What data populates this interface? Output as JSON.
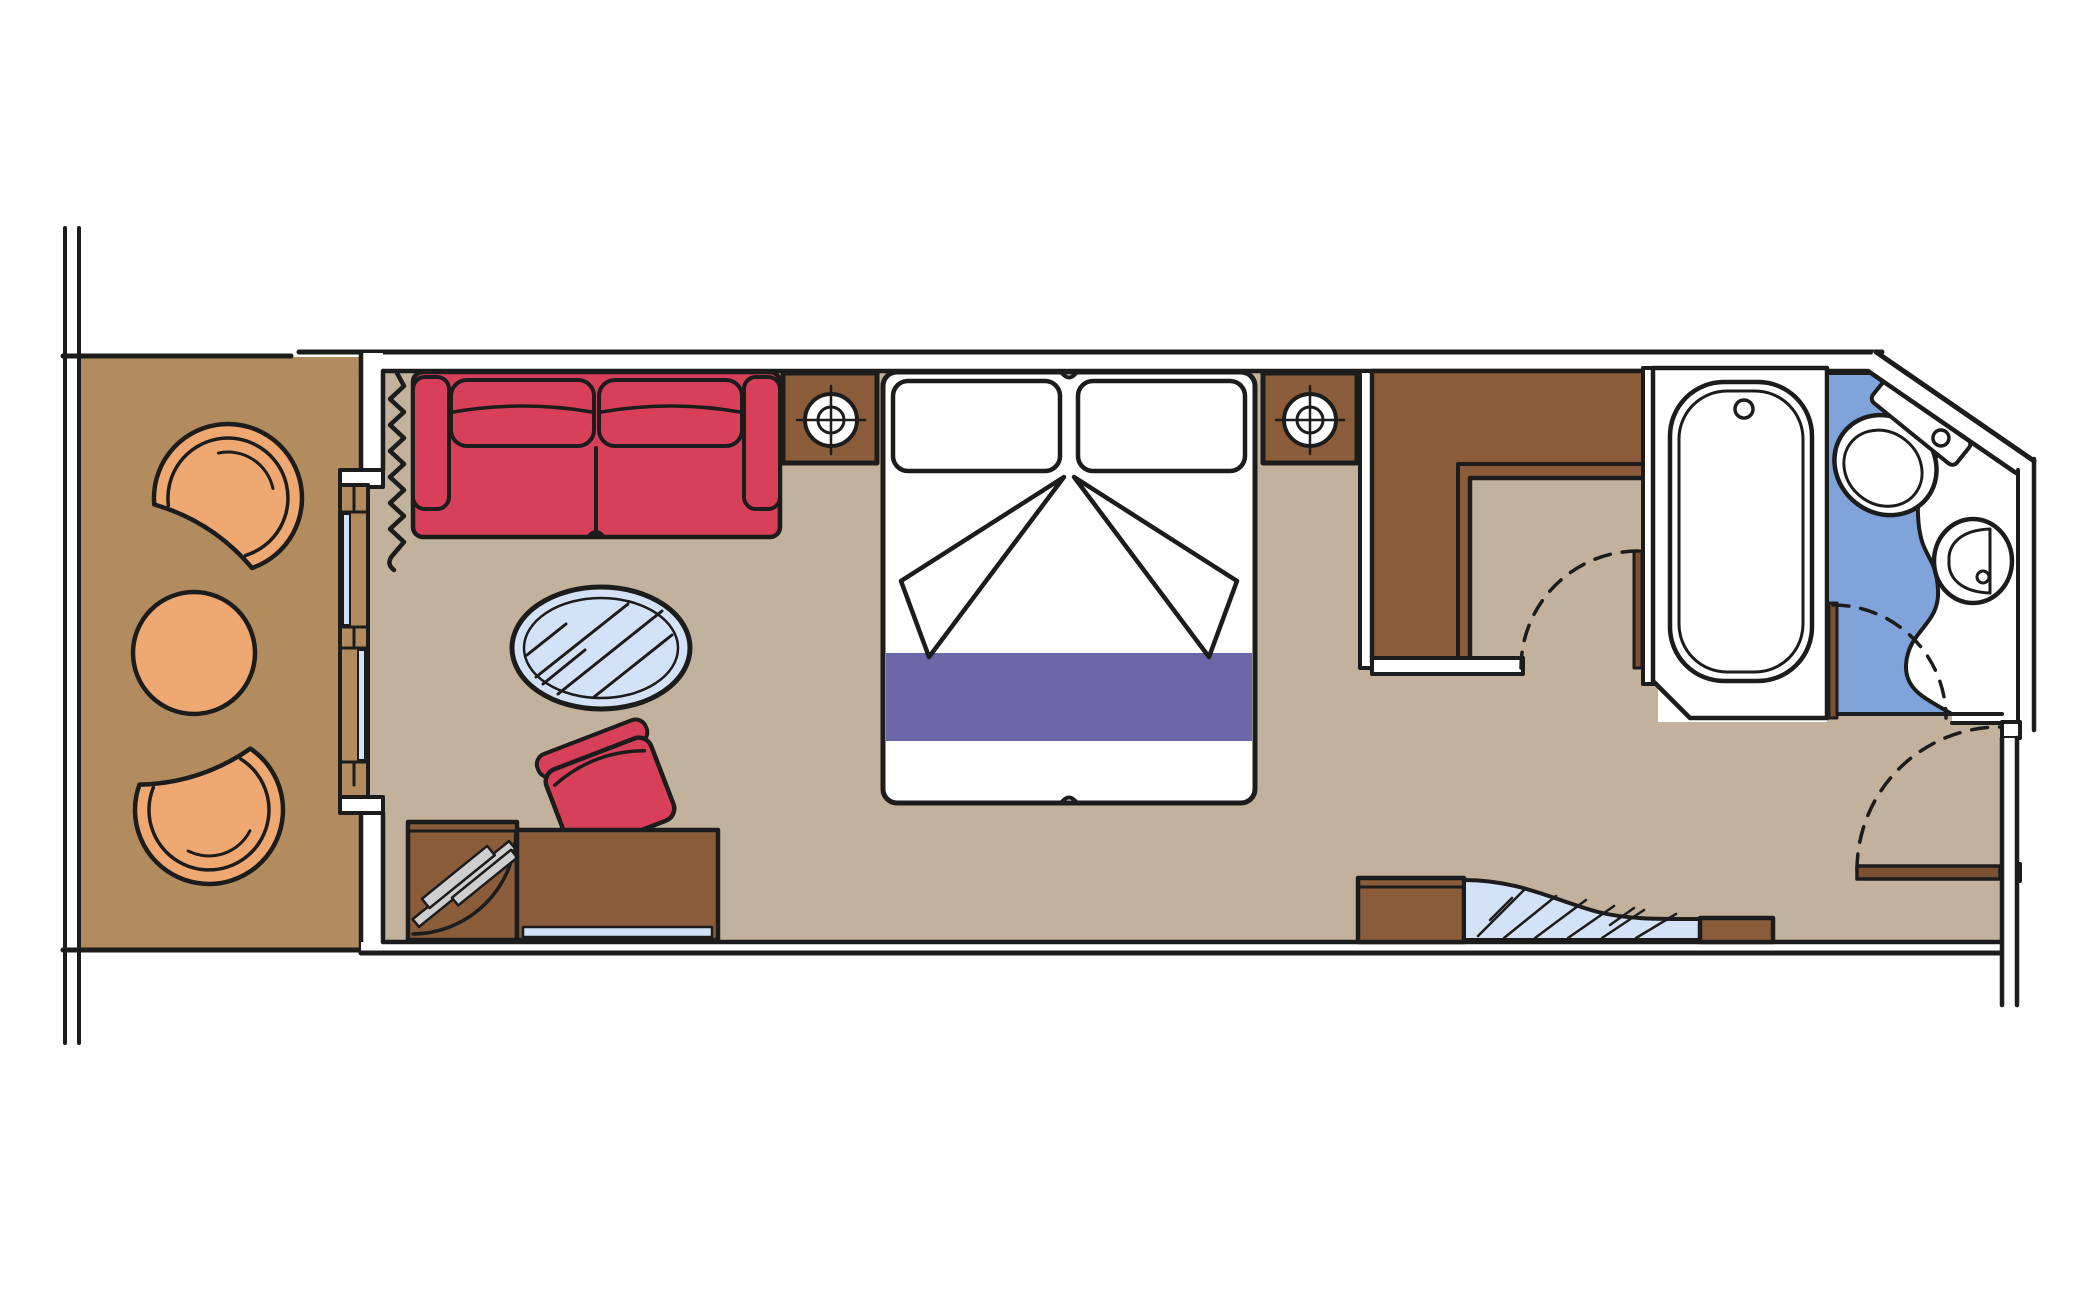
{
  "title": "stateroom-floor-plan",
  "colors": {
    "background": "#ffffff",
    "outline": "#1c1c1c",
    "wall_white": "#ffffff",
    "balcony_floor": "#b28c5e",
    "cabin_floor": "#c2b19c",
    "wood_brown": "#8a5c3a",
    "door_brown": "#7d5233",
    "upholstery_red": "#d8405a",
    "chair_peach": "#f0a873",
    "glass_blue": "#d3e2f6",
    "bathroom_floor": "#80a4d9",
    "bed_runner_purple": "#6b66a5",
    "fixture_white": "#ffffff",
    "tv_gray": "#cfcfcf"
  },
  "rooms": {
    "balcony": "balcony",
    "living_sleeping_area": "living-sleeping-area",
    "dressing_nook": "dressing-nook",
    "bathroom": "bathroom",
    "entrance": "entrance-corridor"
  },
  "furniture": [
    "balcony-chair",
    "balcony-chair",
    "balcony-table",
    "sliding-glass-door",
    "curtain",
    "sofa",
    "nightstand-with-lamp",
    "nightstand-with-lamp",
    "double-bed",
    "pillow",
    "pillow",
    "bed-runner",
    "oval-glass-table",
    "red-pouf",
    "tv-cabinet",
    "desk",
    "wardrobe-closet",
    "mirror-unit",
    "bathtub",
    "toilet",
    "washbasin",
    "door",
    "door",
    "door",
    "entrance-door"
  ]
}
